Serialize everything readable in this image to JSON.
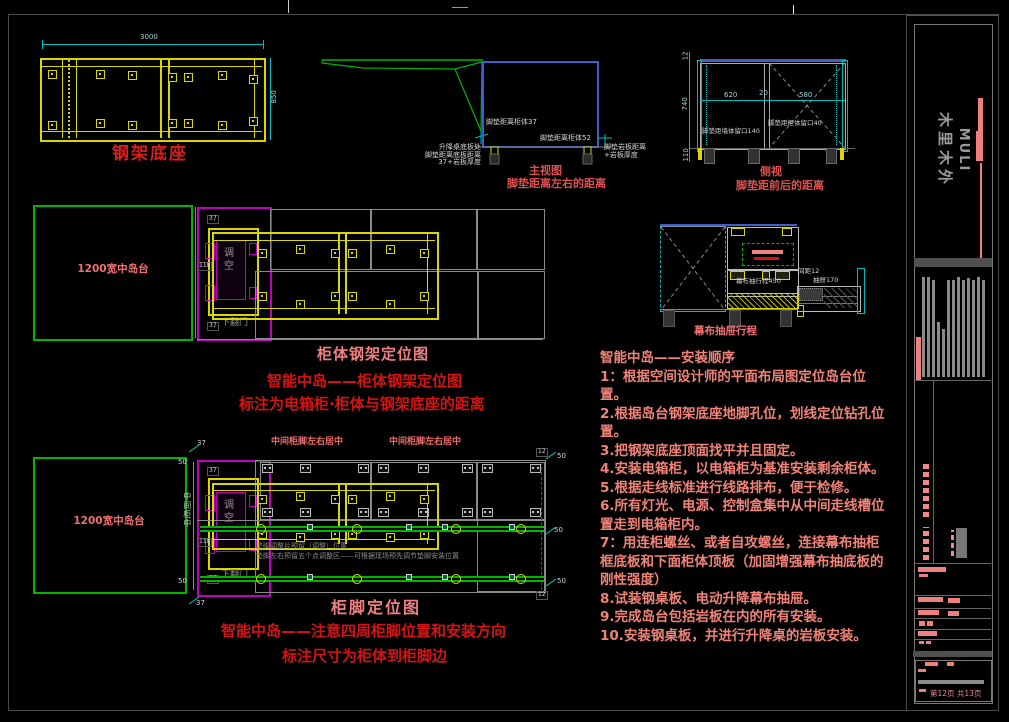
{
  "colors": {
    "yellow": "#d8d800",
    "green": "#00b400",
    "cyan": "#00bcbc",
    "magenta": "#c000c0",
    "blue": "#3c5fd0",
    "red": "#d41414",
    "salmon": "#f08080",
    "gray": "#8a8a8a"
  },
  "d1": {
    "title": "钢架底座",
    "dim_w": "3000",
    "dim_h": "850"
  },
  "d2": {
    "caption1": "主视图",
    "caption2": "脚垫距离左右的距离",
    "foot_left": "脚垫距离柜体37",
    "foot_right": "脚垫距离柜体52",
    "note_l1": "升降桌底板处",
    "note_l2": "脚垫距离底板距离",
    "note_l3": "37+岩板厚度",
    "note_r1": "脚垫岩板距离",
    "note_r2": "+岩板厚度"
  },
  "d3": {
    "caption1": "侧视",
    "caption2": "脚垫距前后的距离",
    "dim_top": "12",
    "dim_mid": "740",
    "dim_bot": "110",
    "dim_l": "620",
    "dim_c": "20",
    "dim_r": "580",
    "label_left": "脚垫距墙体留口140",
    "label_right": "脚垫距柜体留口40"
  },
  "d4": {
    "island": "1200宽中岛台",
    "adj": "调空",
    "door": "下翻门",
    "dim_a": "37",
    "dim_b": "118",
    "dim_c": "37",
    "title": "柜体钢架定位图",
    "note1": "智能中岛——柜体钢架定位图",
    "note2": "标注为电箱柜·柜体与钢架底座的距离"
  },
  "d5": {
    "travel": "幕布抽行程450",
    "gap": "间距12",
    "drawer": "抽屉170",
    "caption": "幕布抽屉行程"
  },
  "d6": {
    "island": "1200宽中岛台",
    "adj": "调空",
    "door": "下翻门",
    "top_label": "中间柜脚左右居中",
    "side_label": "中间柜中",
    "gray1": "垫脚调整片预留（调整）位置",
    "gray2": "垫脚左右预留五个点调整区——可根据现场预先调节垫脚安装位置",
    "dim_37": "37",
    "dim_50": "50",
    "dim_12": "12",
    "dim_118": "118",
    "title": "柜脚定位图",
    "note1": "智能中岛——注意四周柜脚位置和安装方向",
    "note2": "标注尺寸为柜体到柜脚边"
  },
  "instructions": {
    "title": "智能中岛——安装顺序",
    "steps": [
      "1：根据空间设计师的平面布局图定位岛台位置。",
      "2.根据岛台钢架底座地脚孔位，划线定位钻孔位置。",
      "3.把钢架底座顶面找平并且固定。",
      "4.安装电箱柜，以电箱柜为基准安装剩余柜体。",
      "5.根据走线标准进行线路排布，便于检修。",
      "6.所有灯光、电源、控制盒集中从中间走线槽位置走到电箱柜内。",
      "7：用连柜螺丝、或者自攻螺丝，连接幕布抽柜框底板和下面柜体顶板（加固增强幕布抽底板的刚性强度）",
      "8.试装钢桌板、电动升降幕布抽屉。",
      "9.完成岛台包括岩板在内的所有安装。",
      "10.安装钢桌板，并进行升降桌的岩板安装。"
    ]
  },
  "brand": {
    "en": "MULI",
    "cn": "木里木外"
  },
  "page": {
    "page_info": "第12页 共13页"
  }
}
